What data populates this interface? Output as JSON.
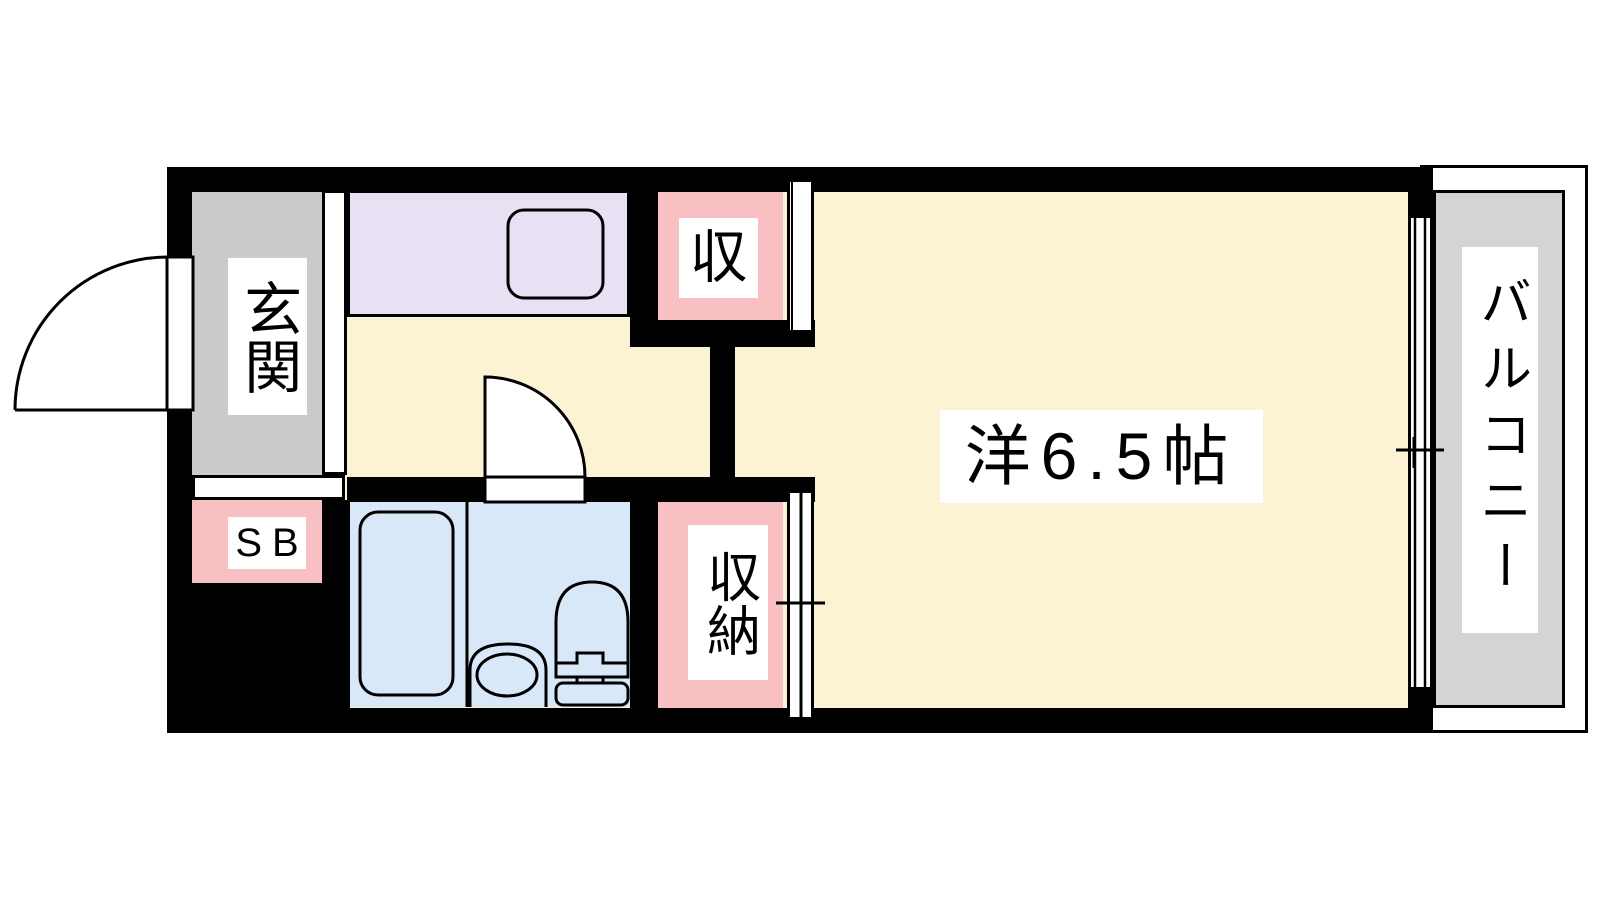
{
  "rooms": {
    "entrance": {
      "label": "玄関"
    },
    "shoe_box": {
      "label": "SB"
    },
    "kitchen": {
      "label": ""
    },
    "bathroom": {
      "label": ""
    },
    "closet_upper": {
      "label": "収"
    },
    "closet_lower": {
      "label": "収納"
    },
    "main_room": {
      "label": "洋6.5帖"
    },
    "balcony": {
      "label": "バルコニー"
    }
  },
  "colors": {
    "wall": "#000000",
    "floor": "#fcf2d4",
    "kitchen": "#e8e0f3",
    "bathroom": "#d8e8f8",
    "closet": "#f9c0c4",
    "entrance_floor": "#cbcbcb",
    "balcony_deck": "#d4d4d4",
    "outline": "#000000",
    "label_background": "#ffffff"
  },
  "fixtures": {
    "entrance_door": "entrance-door-swing-icon",
    "room_door": "room-door-swing-icon",
    "kitchen_sink": "kitchen-sink-icon",
    "bathtub": "bathtub-icon",
    "toilet": "toilet-icon",
    "wash_basin": "wash-basin-icon",
    "window": "sliding-window-icon",
    "closet_door": "sliding-door-icon"
  }
}
